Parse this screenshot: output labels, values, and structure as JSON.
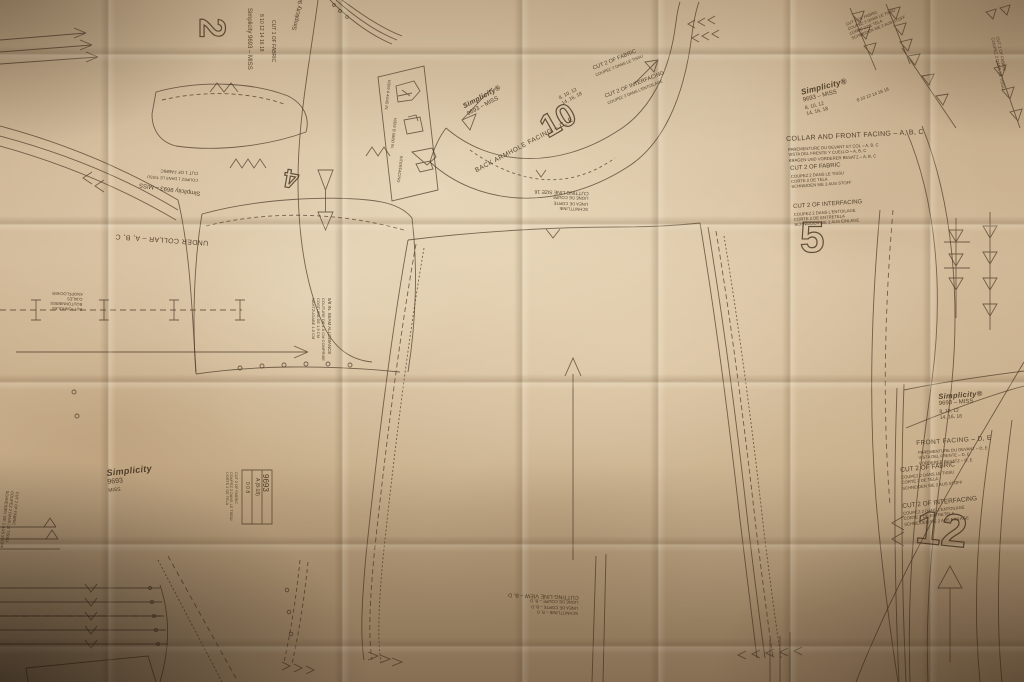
{
  "brand": "Simplicity",
  "pattern": {
    "number": "9693",
    "fit": "MISS",
    "number_fit": "9693 – MISS",
    "sizes1": "8, 10, 12",
    "sizes2": "14, 16, 18",
    "sizes_inline": "8 10 12 14 16 18",
    "id_box": {
      "number": "9693",
      "line1": "A (8-18)",
      "line2": "0 0 8"
    }
  },
  "corner_logo": {
    "brand": "Simplicity",
    "number": "9693",
    "fit": "MISS"
  },
  "pieces": {
    "p2": {
      "num": "2",
      "brand_line": "Simplicity 9693 – MISS",
      "sizes": "8 10 12 14 16 18",
      "note": "CUT 1 OF FABRIC"
    },
    "p4": {
      "num": "4",
      "title": "UNDER COLLAR – A, B, C",
      "brand_line": "Simplicity 9693 – MISS",
      "note": "CUT 1 OF FABRIC",
      "note_fr": "COUPEZ 1 DANS LE TISSU"
    },
    "p5": {
      "num": "5",
      "brand": "Simplicity®",
      "number_fit": "9693 – MISS",
      "sizes1": "8, 10, 12",
      "sizes2": "14, 16, 18",
      "title": "COLLAR AND FRONT FACING – A, B, C",
      "title_fr": "PAREMENTURE DU DEVANT ET COL – A, B, C",
      "title_es": "VISTA DEL FRENTE Y CUELLO – A, B, C",
      "title_de": "KRAGEN UND VORDERER BESATZ – A, B, C",
      "cut_fabric": "CUT 2 OF FABRIC",
      "cut_fabric_fr": "COUPEZ 2 DANS LE TISSU",
      "cut_fabric_es": "CORTE 2 DE TELA",
      "cut_fabric_de": "SCHNEIDEN SIE 2 AUS STOFF",
      "cut_inter": "CUT 2 OF INTERFACING",
      "cut_inter_fr": "COUPEZ 2 DANS L'ENTOILAGE",
      "cut_inter_es": "CORTE 2 DE ENTRETELA",
      "cut_inter_de": "SCHNEIDEN SIE 2 AUS EINLAGE"
    },
    "p10": {
      "num": "10",
      "brand": "Simplicity®",
      "number_fit": "9693 – MISS",
      "sizes1": "8, 10, 12",
      "sizes2": "14, 16, 18",
      "title": "BACK ARMHOLE FACING – C, E",
      "cut_fabric": "CUT 2 OF FABRIC",
      "cut_fabric_fr": "COUPEZ 2 DANS LE TISSU",
      "cut_inter": "CUT 2 OF INTERFACING",
      "cut_inter_fr": "COUPEZ 2 DANS L'ENTOILAGE"
    },
    "p12": {
      "num": "12",
      "brand": "Simplicity®",
      "number_fit": "9693 – MISS",
      "sizes1": "8, 10, 12",
      "sizes2": "14, 16, 18",
      "title": "FRONT FACING – D, E",
      "title_fr": "PAREMENTURE DU DEVANT – D, E",
      "title_es": "VISTA DEL FRENTE – D, E",
      "title_de": "VORDERER BESATZ – D, E",
      "cut_fabric": "CUT 2 OF FABRIC",
      "cut_fabric_fr": "COUPEZ 2 DANS LE TISSU",
      "cut_fabric_es": "CORTE 2 DE TELA",
      "cut_fabric_de": "SCHNEIDEN SIE 2 AUS STOFF",
      "cut_inter": "CUT 2 OF INTERFACING",
      "cut_inter_fr": "COUPEZ 2 DANS L'ENTOILAGE",
      "cut_inter_es": "CORTE 2 DE ENTRETELA",
      "cut_inter_de": "SCHNEIDEN SIE 2 AUS EINLAGE"
    }
  },
  "center_panel": {
    "cutting_line": "CUTTING LINE VIEW – B, D",
    "cutting_line_fr": "LIGNE DE COUPE – B, D",
    "cutting_line_es": "LINEA DE CORTE – B, D",
    "cutting_line_de": "SCHNITTLINIE – B, D",
    "top_note": "CUTTING LINE SIZE 16",
    "top_note_fr": "LIGNE DE COUPE",
    "top_note_es": "LINEA DE CORTE",
    "top_note_de": "SCHNITTLINIE",
    "seam1": "5/8 IN. SEAM ALLOWANCE",
    "seam2": "COUTURE DE 1.5 CM COMPRISE",
    "seam3": "COSTURA DE 1.5 CM",
    "seam4": "NAHTZUGABE 1.5 CM"
  },
  "marks": {
    "buttonhole1": "BUTTONHOLES",
    "buttonhole2": "BOUTONNIERES",
    "buttonhole3": "OJALES",
    "buttonhole4": "KNOPFLOCHER"
  },
  "layout_box": {
    "cap1": "VIEW A 44/45 IN.",
    "cap2": "VIEW B 58/60 IN.",
    "cap3": "INTERFACING"
  },
  "micro": {
    "l1": "CUT 2 OF FABRIC",
    "l2": "COUPEZ 2 DANS LE TISSU",
    "l3": "CORTE 2 DE TELA",
    "l4": "SCHNEIDEN SIE 2 AUS STOFF"
  }
}
